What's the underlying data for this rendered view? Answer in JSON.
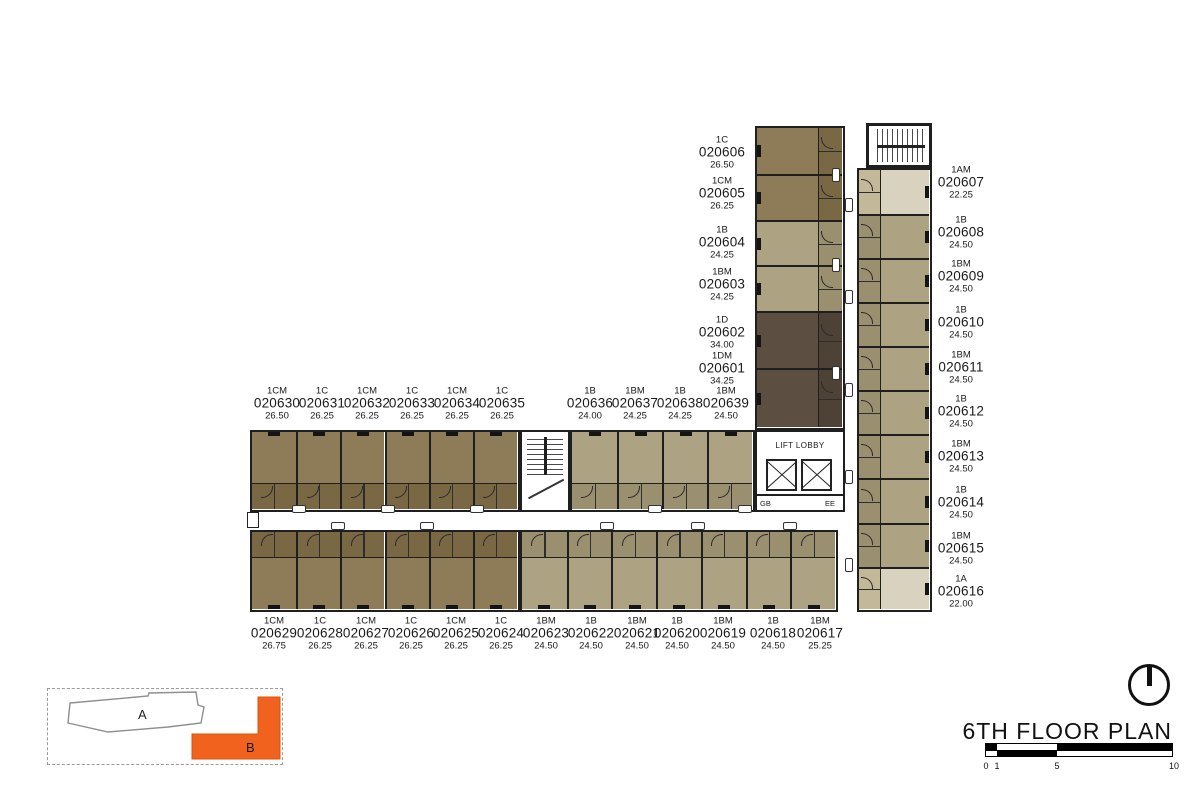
{
  "title": "6TH FLOOR PLAN",
  "labels": {
    "lift_lobby": "LIFT LOBBY",
    "gb": "GB",
    "ee": "EE"
  },
  "key_plan": {
    "building_a_label": "A",
    "building_b_label": "B",
    "highlight_color": "#F2621F"
  },
  "scale_bar": {
    "ticks": [
      "0",
      "1",
      "5",
      "10"
    ]
  },
  "colors": {
    "wall": "#1f1f1f",
    "brown": "#8E7B57",
    "brown_pod": "#7A6844",
    "khaki": "#ADA281",
    "khaki_pod": "#9A8F6E",
    "dark": "#5C4E41",
    "dark_pod": "#4E4236",
    "light": "#D9D2BF",
    "light_pod": "#C3B897"
  },
  "units": {
    "top_column": [
      {
        "t": "1C",
        "no": "020606",
        "a": "26.50",
        "c": "brown"
      },
      {
        "t": "1CM",
        "no": "020605",
        "a": "26.25",
        "c": "brown"
      },
      {
        "t": "1B",
        "no": "020604",
        "a": "24.25",
        "c": "khaki"
      },
      {
        "t": "1BM",
        "no": "020603",
        "a": "24.25",
        "c": "khaki"
      },
      {
        "t": "1D",
        "no": "020602",
        "a": "34.00",
        "c": "dark"
      },
      {
        "t": "1DM",
        "no": "020601",
        "a": "34.25",
        "c": "dark"
      }
    ],
    "right_column": [
      {
        "t": "1AM",
        "no": "020607",
        "a": "22.25",
        "c": "light"
      },
      {
        "t": "1B",
        "no": "020608",
        "a": "24.50",
        "c": "khaki"
      },
      {
        "t": "1BM",
        "no": "020609",
        "a": "24.50",
        "c": "khaki"
      },
      {
        "t": "1B",
        "no": "020610",
        "a": "24.50",
        "c": "khaki"
      },
      {
        "t": "1BM",
        "no": "020611",
        "a": "24.50",
        "c": "khaki"
      },
      {
        "t": "1B",
        "no": "020612",
        "a": "24.50",
        "c": "khaki"
      },
      {
        "t": "1BM",
        "no": "020613",
        "a": "24.50",
        "c": "khaki"
      },
      {
        "t": "1B",
        "no": "020614",
        "a": "24.50",
        "c": "khaki"
      },
      {
        "t": "1BM",
        "no": "020615",
        "a": "24.50",
        "c": "khaki"
      },
      {
        "t": "1A",
        "no": "020616",
        "a": "22.00",
        "c": "light"
      }
    ],
    "top_row": [
      {
        "t": "1CM",
        "no": "020630",
        "a": "26.50",
        "c": "brown"
      },
      {
        "t": "1C",
        "no": "020631",
        "a": "26.25",
        "c": "brown"
      },
      {
        "t": "1CM",
        "no": "020632",
        "a": "26.25",
        "c": "brown"
      },
      {
        "t": "1C",
        "no": "020633",
        "a": "26.25",
        "c": "brown"
      },
      {
        "t": "1CM",
        "no": "020634",
        "a": "26.25",
        "c": "brown"
      },
      {
        "t": "1C",
        "no": "020635",
        "a": "26.25",
        "c": "brown"
      },
      {
        "t": "1B",
        "no": "020636",
        "a": "24.00",
        "c": "khaki"
      },
      {
        "t": "1BM",
        "no": "020637",
        "a": "24.25",
        "c": "khaki"
      },
      {
        "t": "1B",
        "no": "020638",
        "a": "24.25",
        "c": "khaki"
      },
      {
        "t": "1BM",
        "no": "020639",
        "a": "24.50",
        "c": "khaki"
      }
    ],
    "bottom_row": [
      {
        "t": "1CM",
        "no": "020629",
        "a": "26.75",
        "c": "brown"
      },
      {
        "t": "1C",
        "no": "020628",
        "a": "26.25",
        "c": "brown"
      },
      {
        "t": "1CM",
        "no": "020627",
        "a": "26.25",
        "c": "brown"
      },
      {
        "t": "1C",
        "no": "020626",
        "a": "26.25",
        "c": "brown"
      },
      {
        "t": "1CM",
        "no": "020625",
        "a": "26.25",
        "c": "brown"
      },
      {
        "t": "1C",
        "no": "020624",
        "a": "26.25",
        "c": "brown"
      },
      {
        "t": "1BM",
        "no": "020623",
        "a": "24.50",
        "c": "khaki"
      },
      {
        "t": "1B",
        "no": "020622",
        "a": "24.50",
        "c": "khaki"
      },
      {
        "t": "1BM",
        "no": "020621",
        "a": "24.50",
        "c": "khaki"
      },
      {
        "t": "1B",
        "no": "020620",
        "a": "24.50",
        "c": "khaki"
      },
      {
        "t": "1BM",
        "no": "020619",
        "a": "24.50",
        "c": "khaki"
      },
      {
        "t": "1B",
        "no": "020618",
        "a": "24.50",
        "c": "khaki"
      },
      {
        "t": "1BM",
        "no": "020617",
        "a": "25.25",
        "c": "khaki"
      }
    ]
  }
}
